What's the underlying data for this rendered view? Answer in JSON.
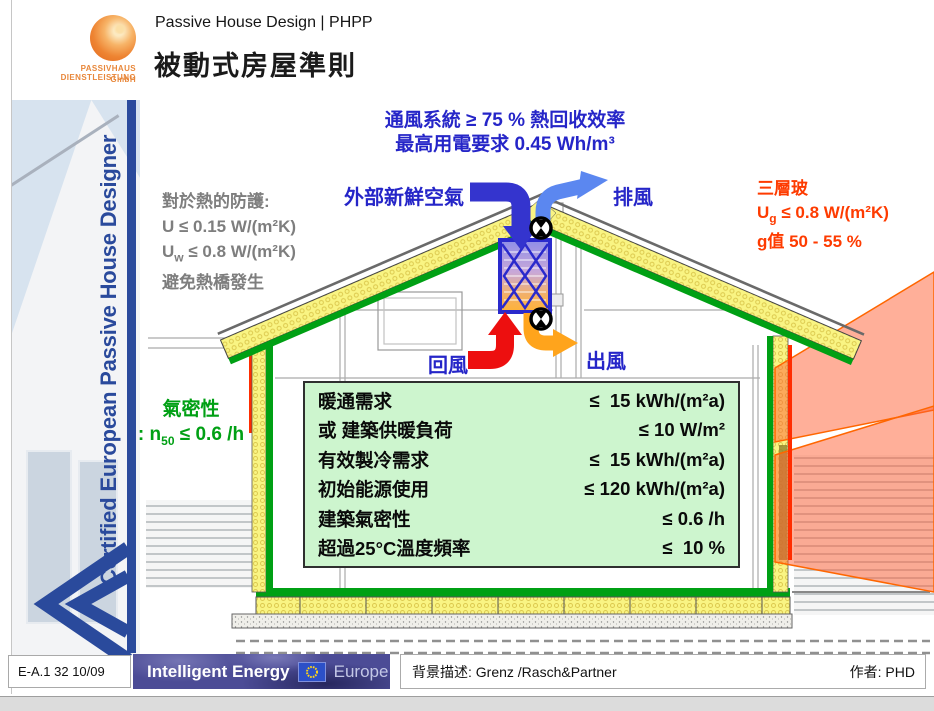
{
  "header": {
    "logo_text_line1": "PASSIVHAUS DIENSTLEISTUNG",
    "logo_text_line2": "GmbH",
    "subtitle": "Passive House Design | PHPP",
    "title": "被動式房屋準則"
  },
  "sidebar": {
    "vertical_text": "Certified European Passive House Designer"
  },
  "diagram": {
    "ventilation_note": {
      "line1": "通風系統 ≥ 75 % 熱回收效率",
      "line2": "最高用電要求 0.45 Wh/m³"
    },
    "fresh_air_label": "外部新鮮空氣",
    "exhaust_air_label": "排風",
    "return_air_label": "回風",
    "supply_air_label": "出風",
    "heat_protection": {
      "line1": "對於熱的防護:",
      "line2": "U ≤ 0.15 W/(m²K)",
      "line3_base": "U",
      "line3_sub": "w",
      "line3_rest": " ≤ 0.8 W/(m²K)",
      "line4": "避免熱橋發生"
    },
    "glazing": {
      "line1": "三層玻",
      "line2_base": "U",
      "line2_sub": "g",
      "line2_rest": " ≤ 0.8 W/(m²K)",
      "line3": "g值 50 - 55 %"
    },
    "airtightness": {
      "line1": "氣密性",
      "line2_prefix": ": n",
      "line2_sub": "50",
      "line2_rest": " ≤ 0.6 /h"
    },
    "requirements": {
      "rows": [
        {
          "label": "暖通需求",
          "value": "≤  15 kWh/(m²a)"
        },
        {
          "label": "或 建築供暖負荷",
          "value": "≤ 10 W/m²"
        },
        {
          "label": "有效製冷需求",
          "value": "≤  15 kWh/(m²a)"
        },
        {
          "label": "初始能源使用",
          "value": "≤ 120 kWh/(m²a)"
        },
        {
          "label": "建築氣密性",
          "value": "≤ 0.6 /h"
        },
        {
          "label": "超過25°C溫度頻率",
          "value": "≤  10 %"
        }
      ]
    }
  },
  "footer": {
    "doc_ref": "E-A.1 32 10/09",
    "energy_logo": {
      "bold": "Intelligent Energy",
      "light": "Europe"
    },
    "background_credit": "背景描述: Grenz /Rasch&Partner",
    "author": "作者: PHD"
  },
  "colors": {
    "accent_blue": "#2A4A9C",
    "label_blue": "#2525C8",
    "label_green": "#00A014",
    "label_red": "#FE3B00",
    "label_gray": "#7E7E7E",
    "insulation_yellow": "#F9F483",
    "sun_orange": "#FF5F33",
    "table_green": "#CDF5CE",
    "arrow_fresh_blue": "#3434CE",
    "arrow_exhaust_blue": "#5B87F0",
    "arrow_return_red": "#ED0F0F",
    "arrow_supply_orange": "#FFA41C"
  }
}
